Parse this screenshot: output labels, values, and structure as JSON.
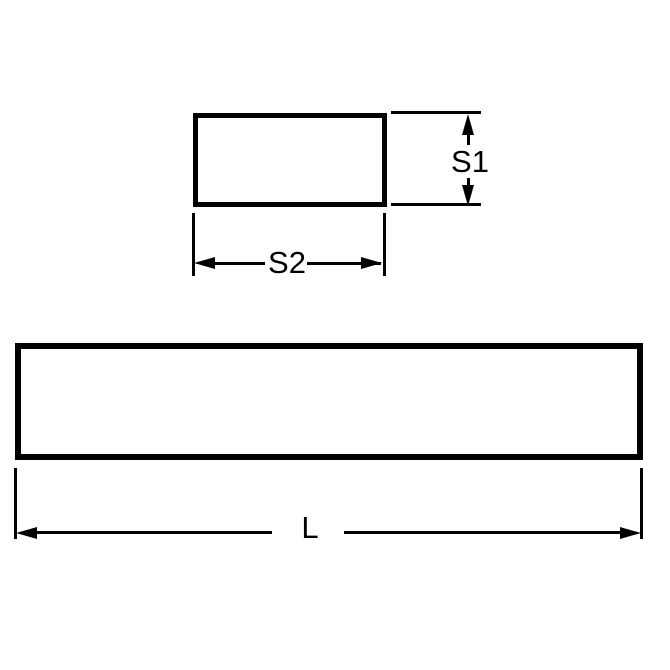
{
  "colors": {
    "background": "#ffffff",
    "line": "#000000"
  },
  "views": {
    "cross_section": {
      "labels": {
        "height": "S1",
        "width": "S2"
      }
    },
    "side": {
      "labels": {
        "length": "L"
      }
    }
  }
}
